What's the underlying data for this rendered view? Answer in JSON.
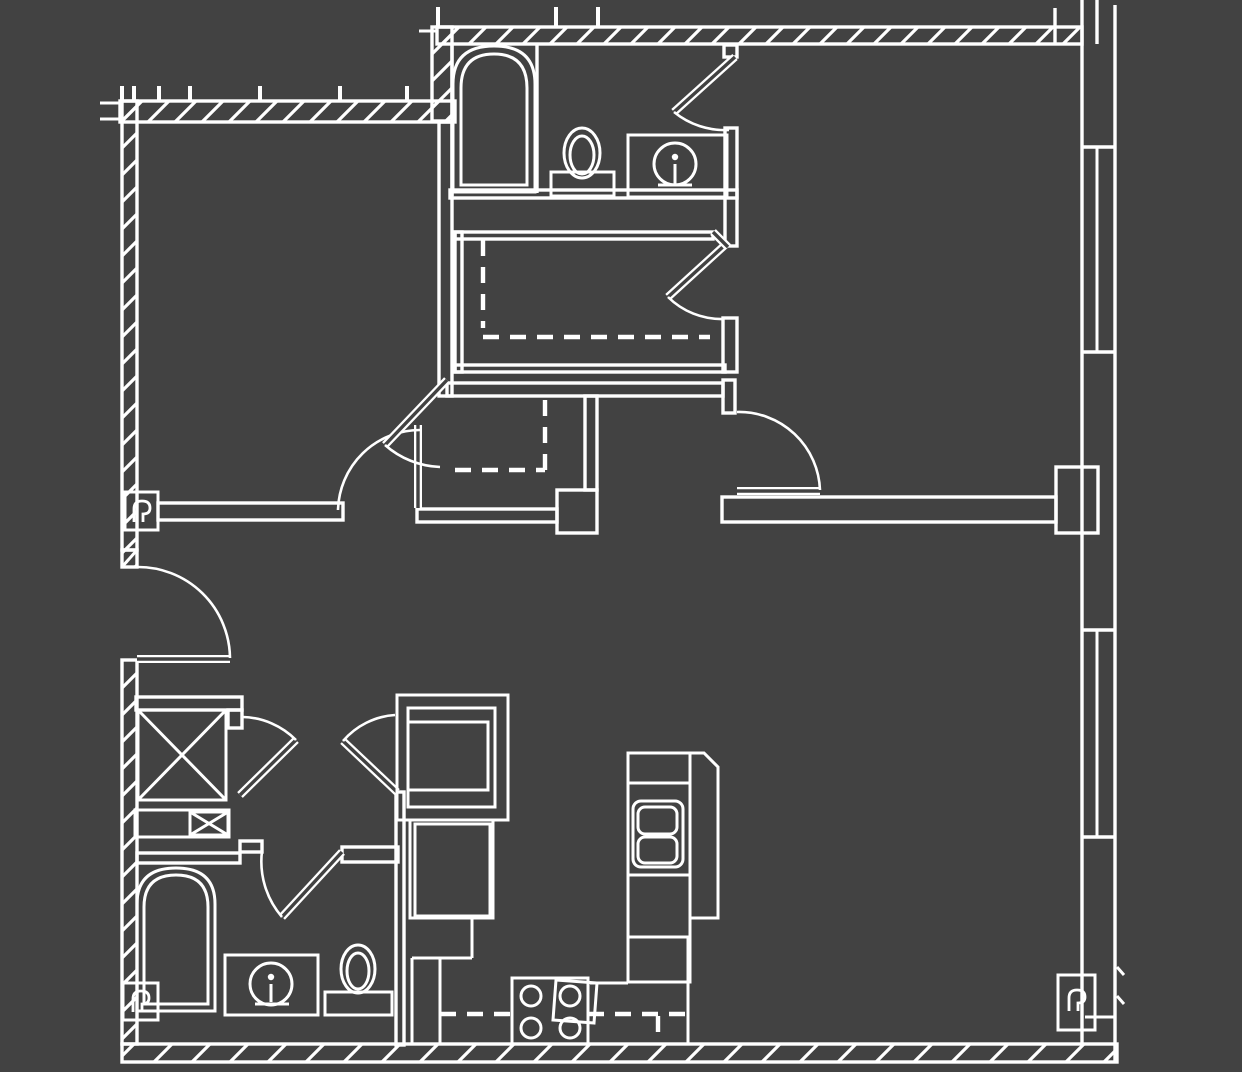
{
  "document": {
    "kind": "architectural-floor-plan",
    "visible_text": "",
    "palette": {
      "background": "#424242",
      "line_color": "#ffffff"
    },
    "wall_styles": {
      "exterior": "double line with 45-degree diagonal hatch",
      "interior": "parallel double lines, unfilled",
      "curtain_wall": "double line with center glazing line at window bays"
    },
    "symbols_present": [
      "bathtub-icon",
      "toilet-icon",
      "vanity-sink-icon",
      "faucet-icon",
      "kitchen-double-sink-icon",
      "range-four-burner-icon",
      "refrigerator-icon",
      "washer-dryer-x-box-icon",
      "door-swing-arc",
      "door-leaf",
      "closet-rod-dashed-line",
      "window-glazing-line",
      "column-marker-square",
      "wall-hatch",
      "grid-tick"
    ],
    "counts": {
      "bathtubs": 2,
      "toilets": 2,
      "vanity_sinks": 2,
      "kitchen_sinks": 1,
      "range_burners": 4,
      "door_swings": 9,
      "window_bays": 2,
      "column_markers": 3,
      "x_boxes": 2
    }
  }
}
